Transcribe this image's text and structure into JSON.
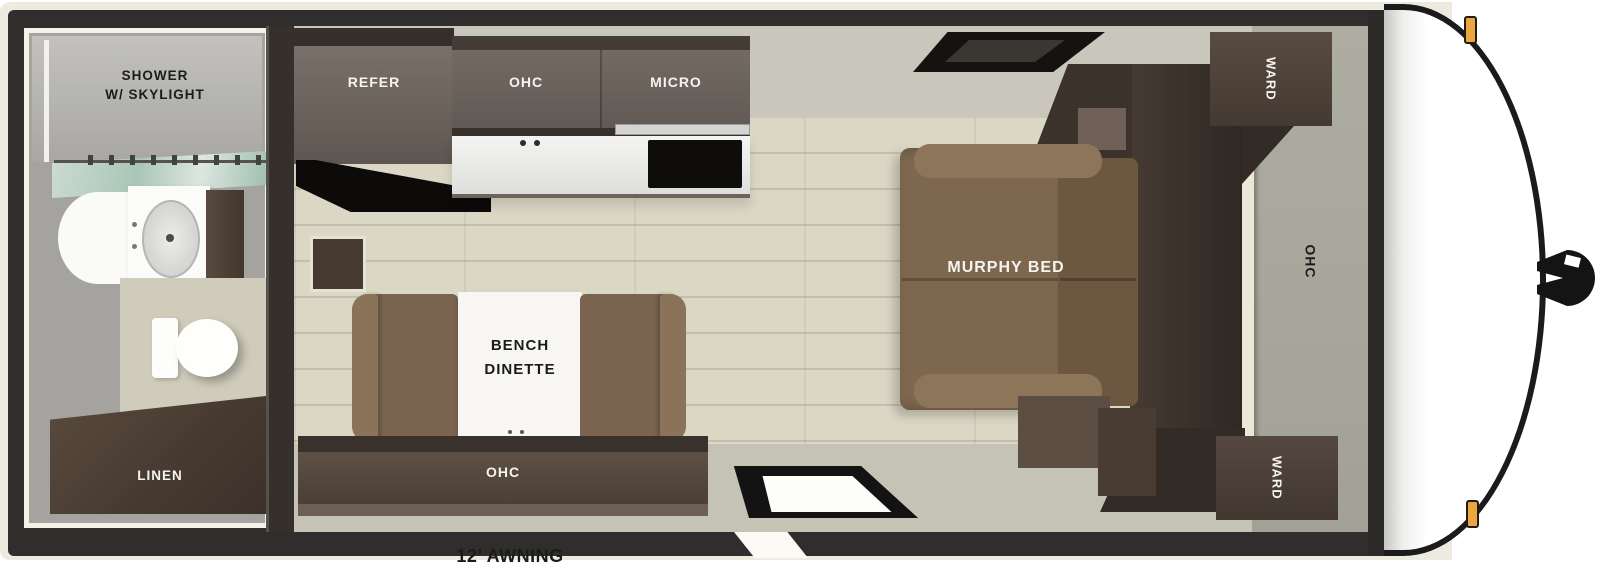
{
  "diagram": {
    "awning_label": "12’ AWNING",
    "bathroom": {
      "shower_line1": "SHOWER",
      "shower_line2": "W/ SKYLIGHT",
      "linen": "LINEN"
    },
    "kitchen": {
      "refer": "REFER",
      "ohc": "OHC",
      "micro": "MICRO"
    },
    "dinette": {
      "bench_line1": "BENCH",
      "bench_line2": "DINETTE",
      "ohc": "OHC"
    },
    "bedroom": {
      "murphy_bed": "MURPHY BED",
      "ward_top": "WARD",
      "ward_bottom": "WARD",
      "ohc": "OHC"
    }
  },
  "colors": {
    "label_dark": "#1b1b1b",
    "label_light": "#f6f4ef",
    "shell_cream": "#edeae0",
    "frame_dark": "#2f2e2c",
    "wall_gray": "#c9c7bb",
    "floor": "#dbd7c5",
    "walkway": "#c5c2b6",
    "cabinet_dark": "#4a3e35",
    "cabinet_face": "#6e6560",
    "sofa_brown": "#7d674f",
    "bench_brown": "#7a6450",
    "panel_green": "#a2a195",
    "glass_teal": "#aac9b9",
    "marker_orange": "#eba73e"
  }
}
